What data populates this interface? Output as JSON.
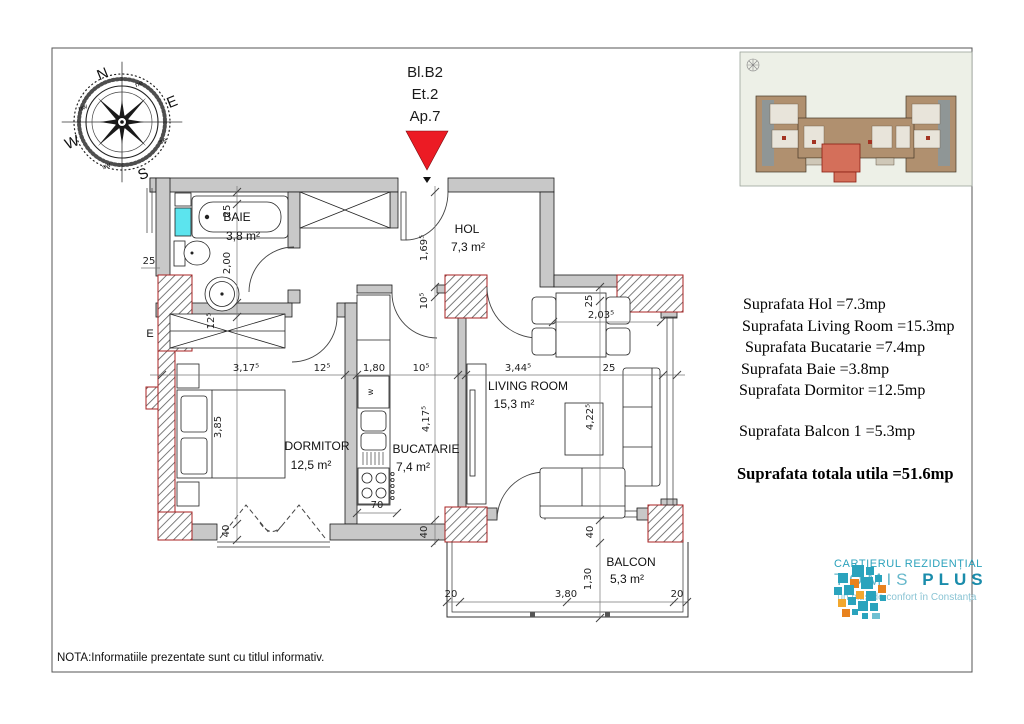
{
  "header": {
    "block": "Bl.B2",
    "floor": "Et.2",
    "apartment": "Ap.7"
  },
  "compass": {
    "n": "N",
    "e": "E",
    "s": "S",
    "w": "W",
    "ne": "ne",
    "se": "se",
    "sw": "sw",
    "nw": "nw"
  },
  "rooms": {
    "baie": {
      "name": "BAIE",
      "area": "3,8 m²"
    },
    "hol": {
      "name": "HOL",
      "area": "7,3 m²"
    },
    "dormitor": {
      "name": "DORMITOR",
      "area": "12,5 m²"
    },
    "bucatarie": {
      "name": "BUCATARIE",
      "area": "7,4 m²"
    },
    "living": {
      "name": "LIVING ROOM",
      "area": "15,3 m²"
    },
    "balcon": {
      "name": "BALCON",
      "area": "5,3 m²"
    }
  },
  "labels": {
    "washing_machine": "w",
    "electric_panel": "E"
  },
  "dims": {
    "baie_w": "25",
    "baie_h": "2,00",
    "left_wall": "25",
    "entry_h": "1,69⁵",
    "entry_wall": "10⁵",
    "ward_d": "12⁵",
    "dorm_w": "3,17⁵",
    "wall_125": "12⁵",
    "kitchen_w": "1,80",
    "wall_105": "10⁵",
    "living_w": "3,44⁵",
    "right_wall": "25",
    "dorm_h": "3,85",
    "kitchen_h": "4,17⁵",
    "living_h": "4,22⁵",
    "dining_wall": "25",
    "dining_w": "2,03⁵",
    "kitchen_70": "70",
    "dorm_40": "40",
    "mid_40": "40",
    "living_40": "40",
    "balcon_20l": "20",
    "balcon_w": "3,80",
    "balcon_20r": "20",
    "balcon_h": "1,30"
  },
  "areas": {
    "lines": [
      "Suprafata Hol =7.3mp",
      "Suprafata Living Room =15.3mp",
      "Suprafata Bucatarie =7.4mp",
      "Suprafata Baie =3.8mp",
      "Suprafata Dormitor =12.5mp"
    ],
    "balcony_line": "Suprafata Balcon 1 =5.3mp",
    "total_line": "Suprafata totala utila =51.6mp"
  },
  "note": "NOTA:Informatiile prezentate sunt cu titlul informativ.",
  "logo": {
    "top": "CARTIERUL REZIDENȚIAL",
    "brand_a": "TOMIS",
    "brand_b": "PLUS",
    "bottom": "un plus de confort în Constanța"
  },
  "colors": {
    "accent_red": "#ec1b24",
    "wall_gray": "#c8c8c8",
    "window_cyan": "#5ce4ee",
    "brand_teal": "#2aa3bd",
    "brand_orange": "#e8821e"
  }
}
